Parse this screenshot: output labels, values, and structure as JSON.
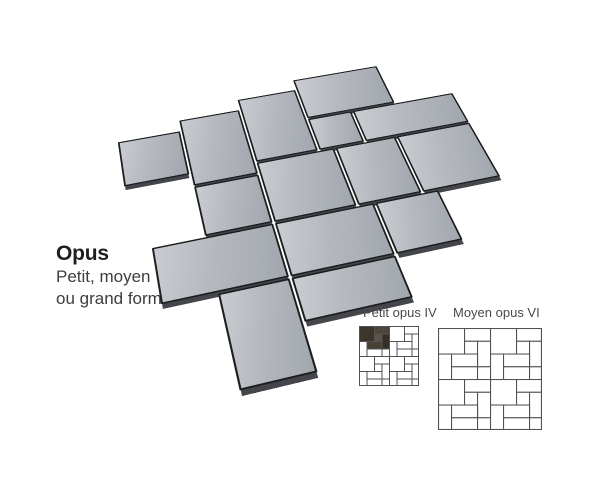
{
  "title": {
    "heading": "Opus",
    "line1": "Petit, moyen",
    "line2": "ou grand format"
  },
  "diagrams": {
    "petit": {
      "label": "Petit opus IV"
    },
    "moyen": {
      "label": "Moyen opus VI"
    }
  },
  "illustration": {
    "description": "Perspective view of grey paving tiles laid in an opus (multi-format) pattern",
    "tile_count": 15
  },
  "colors": {
    "background": "#ffffff",
    "tile_face": "#b5b9bf",
    "tile_face_light": "#c9ccd1",
    "tile_face_dark": "#a2a6ae",
    "tile_joint": "#1d1e20",
    "tile_side": "#44464b",
    "diagram_stroke": "#515257",
    "diagram_fill": "#ffffff",
    "diagram_dark_1": "#3c352c",
    "diagram_dark_2": "#4f463a",
    "diagram_dark_3": "#5b5146",
    "diagram_dark_4": "#362f28",
    "diagram_dark_5": "#4a4135",
    "text_heading": "#1f1f1f",
    "text_subtitle": "#3d3d3d",
    "text_label": "#4a4a4a"
  }
}
